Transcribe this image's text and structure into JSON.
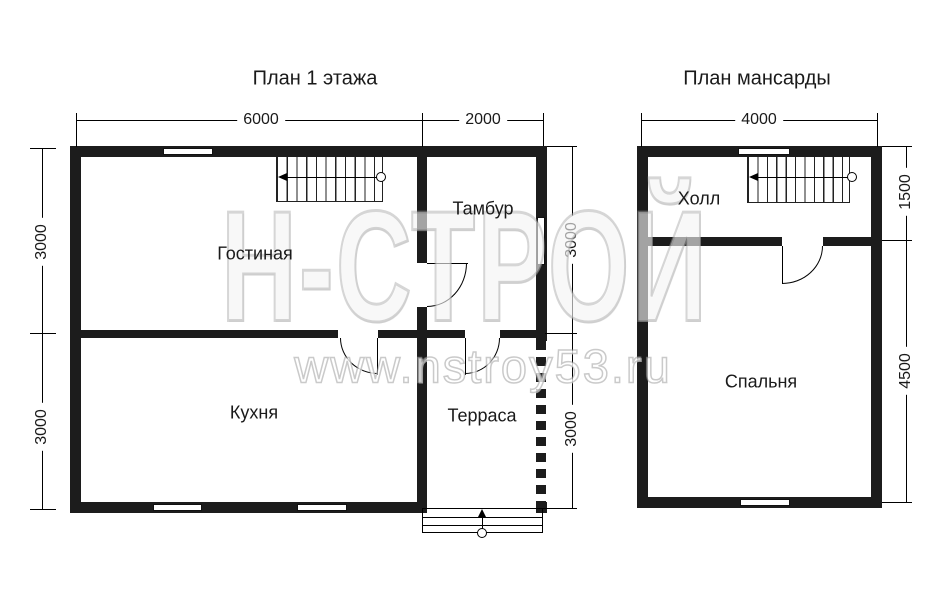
{
  "titles": {
    "floor1": "План 1 этажа",
    "attic": "План мансарды"
  },
  "floor1": {
    "rooms": {
      "living": "Гостиная",
      "vestibule": "Тамбур",
      "kitchen": "Кухня",
      "terrace": "Терраса"
    },
    "dims": {
      "width_main": "6000",
      "width_vestibule": "2000",
      "left_upper": "3000",
      "left_lower": "3000",
      "right_upper": "3000",
      "right_lower": "3000"
    }
  },
  "attic": {
    "rooms": {
      "hall": "Холл",
      "bedroom": "Спальня"
    },
    "dims": {
      "width": "4000",
      "right_upper": "1500",
      "right_lower": "4500"
    }
  },
  "watermark": {
    "logo": "Н-СТРОЙ",
    "url": "www.nstroy53.ru"
  },
  "colors": {
    "wall": "#1c1c1c",
    "line": "#000000",
    "text": "#1a1a1a",
    "watermark": "#c8c8c8"
  }
}
